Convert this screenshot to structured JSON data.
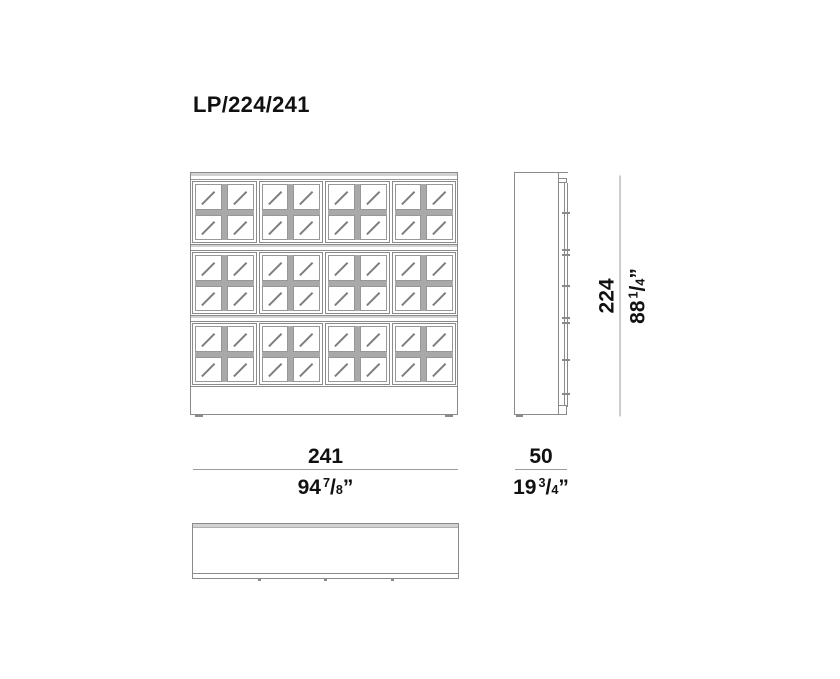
{
  "title": "LP/224/241",
  "glyphs": {
    "fraction_slash": "/",
    "inch_mark": "”"
  },
  "drawing": {
    "views": [
      "front elevation",
      "side elevation",
      "plan"
    ],
    "front_view": {
      "door_rows": 3,
      "door_cols": 4,
      "pane_rows": 2,
      "pane_cols": 2
    }
  },
  "dimensions": {
    "width": {
      "metric_cm": "241",
      "imperial_whole": "94",
      "imperial_numerator": "7",
      "imperial_denominator": "8"
    },
    "depth": {
      "metric_cm": "50",
      "imperial_whole": "19",
      "imperial_numerator": "3",
      "imperial_denominator": "4"
    },
    "height": {
      "metric_cm": "224",
      "imperial_whole": "88",
      "imperial_numerator": "1",
      "imperial_denominator": "4"
    }
  },
  "colors": {
    "line": "#8a8a8a",
    "dim_line": "#9b9b9b",
    "band_fill": "#d2d2d2",
    "mullion": "#a9a9a9",
    "text": "#111111",
    "background": "#ffffff"
  }
}
